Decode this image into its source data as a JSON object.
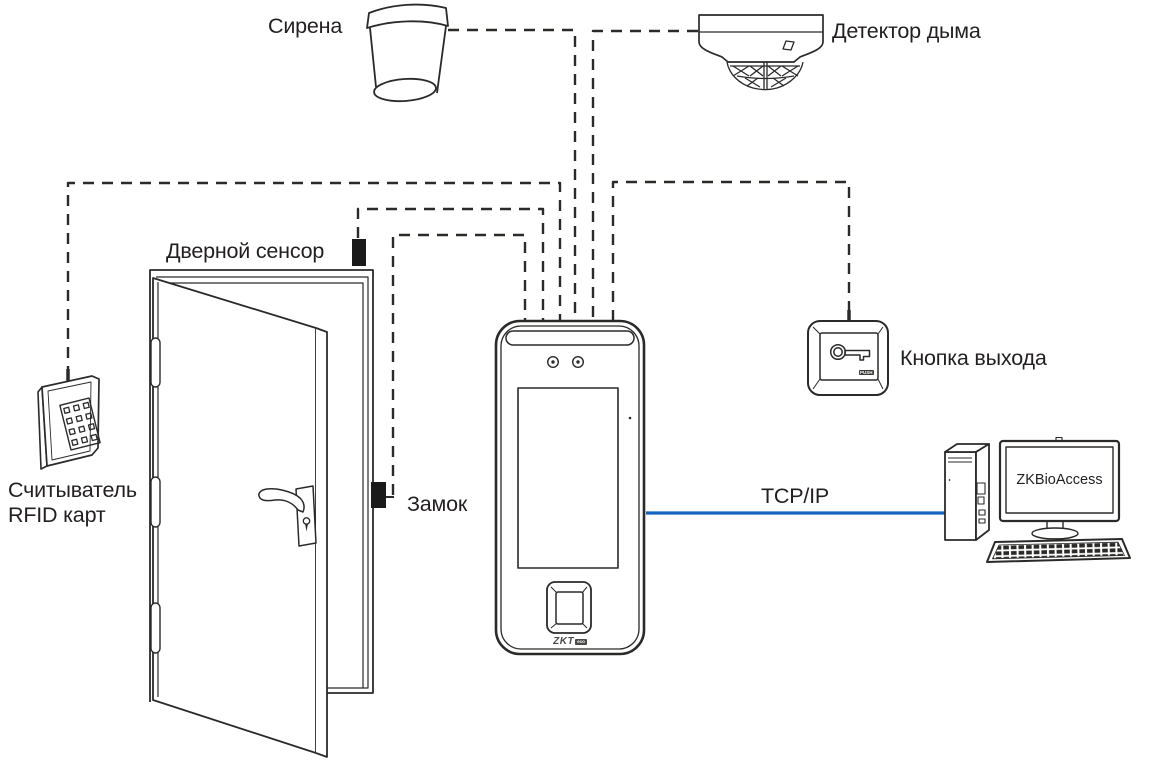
{
  "diagram": {
    "type": "access-control-wiring-diagram",
    "colors": {
      "line": "#2b2a29",
      "text": "#231f20",
      "tcpip_blue": "#1565c0",
      "device_fill": "#1a1a1a"
    },
    "labels": {
      "siren": "Сирена",
      "smoke_detector": "Детектор дыма",
      "door_sensor": "Дверной сенсор",
      "lock": "Замок",
      "rfid_line1": "Считыватель",
      "rfid_line2": "RFID карт",
      "exit_button": "Кнопка выхода",
      "tcpip": "TCP/IP",
      "software": "ZKBioAccess",
      "push": "PUSH",
      "logo_zkt": "ZKT",
      "logo_eco": "eco"
    },
    "connections": [
      {
        "from": "siren",
        "to": "terminal",
        "style": "dashed"
      },
      {
        "from": "smoke-detector",
        "to": "terminal",
        "style": "dashed"
      },
      {
        "from": "rfid-reader",
        "to": "terminal",
        "style": "dashed"
      },
      {
        "from": "door-sensor",
        "to": "terminal",
        "style": "dashed"
      },
      {
        "from": "lock",
        "to": "terminal",
        "style": "dashed"
      },
      {
        "from": "exit-button",
        "to": "terminal",
        "style": "dashed"
      },
      {
        "from": "terminal",
        "to": "computer",
        "style": "solid",
        "label": "TCP/IP"
      }
    ]
  }
}
